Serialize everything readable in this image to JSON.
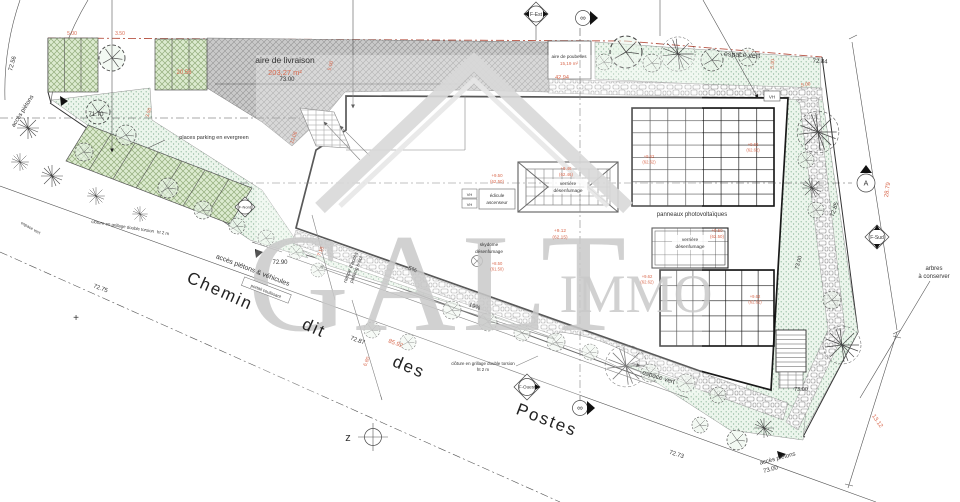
{
  "watermark": {
    "brand": "GALT",
    "suffix": "IMMO"
  },
  "labels": {
    "aire_livraison": "aire de livraison",
    "aire_livraison_surface": "203,27 m²",
    "aire_poubelles": "aire de poubelles",
    "aire_poubelles_surface": "15,19 m²",
    "espace_vert": "espace vert",
    "panneaux": "panneaux photovoltaïques",
    "verriere_1": "verrière",
    "verriere_2": "désenfumage",
    "edicule_1": "édicule",
    "edicule_2": "ascenseur",
    "vh": "VH",
    "skydome_1": "skydome",
    "skydome_2": "désenfumage",
    "places_parking": "places parking en evergreen",
    "rampe_1": "rampe d'accès",
    "rampe_2": "parking s-sol",
    "acces_pietons": "accès piétons",
    "acces_pietons_vehicules": "accès piétons & véhicules",
    "portail": "portail coulissant",
    "cloture": "clôture en grillage double torsion",
    "cloture_ht": "ht 2 m",
    "arbres_1": "arbres",
    "arbres_2": "à conserver"
  },
  "street": {
    "w1": "Chemin",
    "w2": "dit",
    "w3": "des",
    "w4": "Postes"
  },
  "markers": {
    "f_est": "F-Est",
    "f_sud": "F-Sud",
    "f_ouest": "F-Ouest",
    "f_nord": "F-Nord",
    "section_a": "A",
    "survey": "∞",
    "compass": "z",
    "cross": "+"
  },
  "levels": {
    "l7256": "72.56",
    "l7300": "73.00",
    "l7284": "72.84",
    "l7290": "72.90",
    "l7287": "72.87",
    "l7285": "72.85",
    "l7275": "72.75",
    "l7273": "72.73",
    "l7170": "71.70"
  },
  "dims": {
    "d500": "5.00",
    "d350": "3.50",
    "d2056": "20.56",
    "d4294": "42,94",
    "d1206": "12.06",
    "d718": "7.18",
    "d680": "6.80",
    "d8592": "85.92",
    "d1312": "13.12",
    "d2879": "28.79"
  },
  "slopes": {
    "s5": "5%",
    "s19": "19%"
  },
  "elevations": {
    "e950": "+9.50",
    "p6250": "(62.50)",
    "e946": "+9.46",
    "p6246": "(62.46)",
    "e912": "+9.12",
    "p6215": "(62.15)",
    "e850": "+8.50",
    "p6150": "(61.50)",
    "e962": "+9.62",
    "p6262": "(62.62)"
  }
}
